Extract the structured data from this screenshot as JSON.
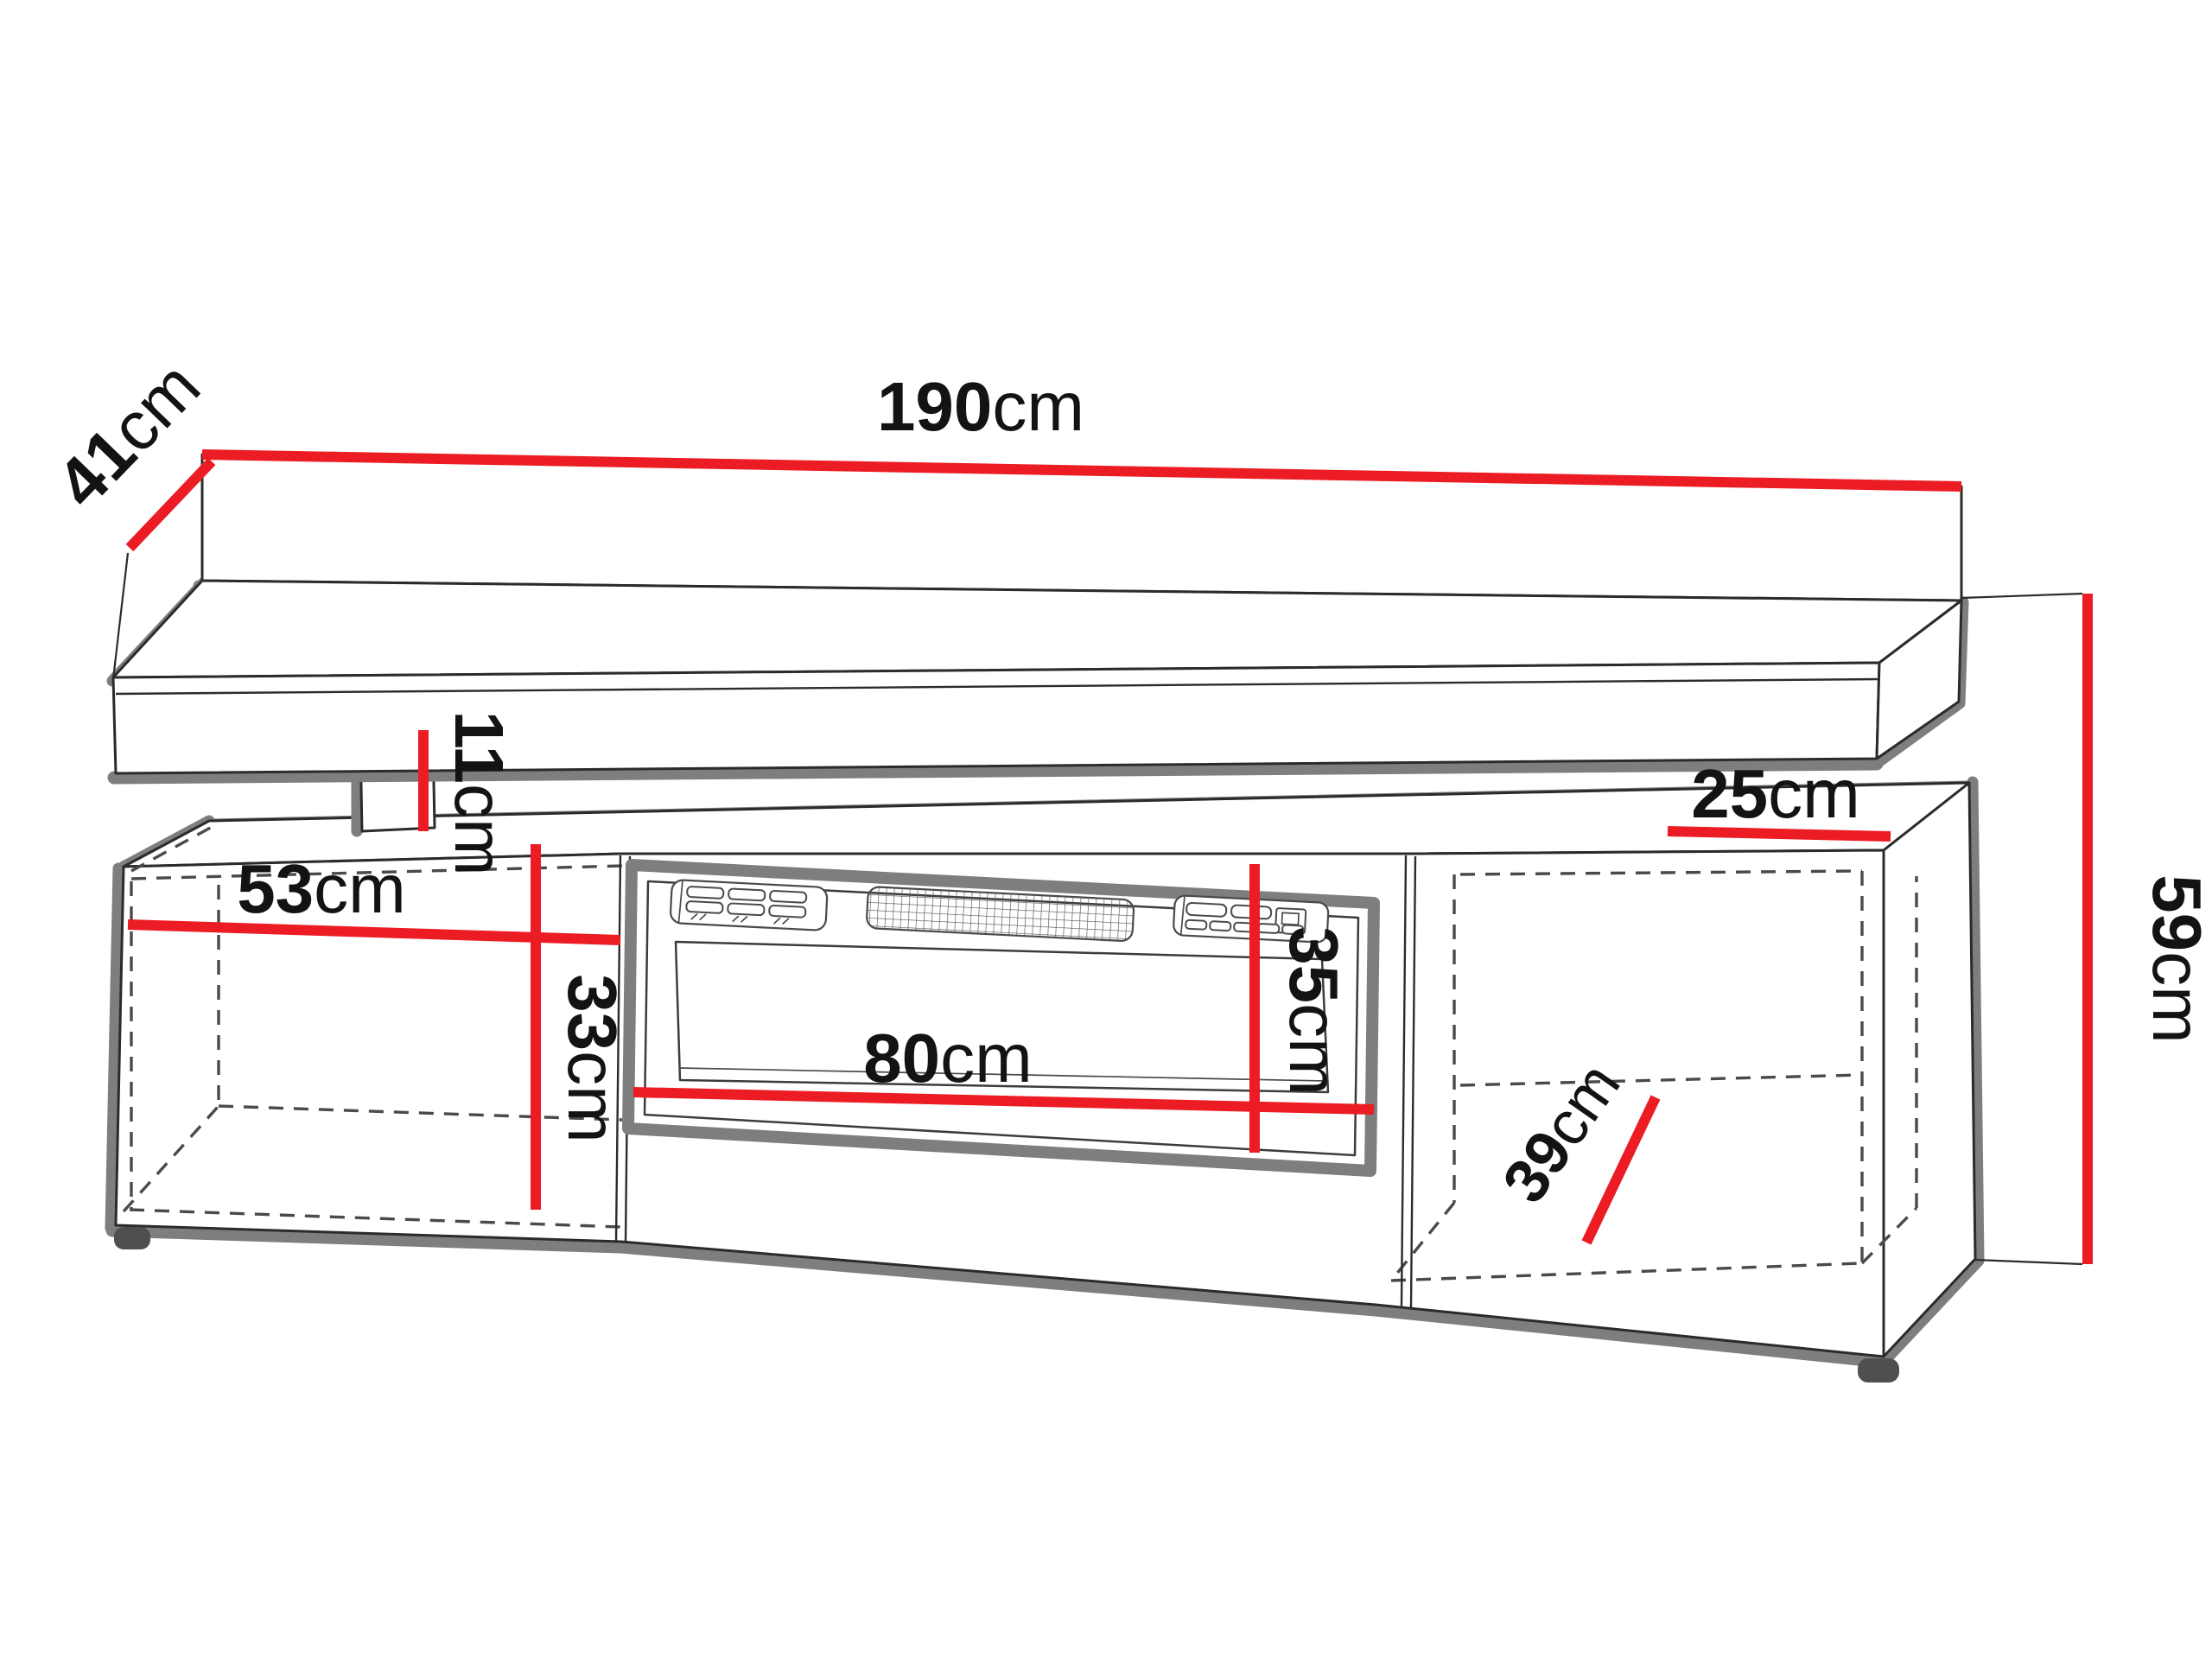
{
  "diagram": {
    "type": "furniture-dimension-diagram",
    "subject": "TV stand with electric fireplace insert and floating wall shelf",
    "unit": "cm",
    "dimensions": {
      "shelf_width": {
        "value": "190",
        "unit": "cm",
        "description": "total width of the floating wall shelf"
      },
      "shelf_depth": {
        "value": "41",
        "unit": "cm",
        "description": "depth of the floating wall shelf"
      },
      "gap_height": {
        "value": "11",
        "unit": "cm",
        "description": "gap between shelf and cabinet top"
      },
      "left_compartment_width": {
        "value": "53",
        "unit": "cm",
        "description": "interior width of left compartment"
      },
      "left_compartment_height": {
        "value": "33",
        "unit": "cm",
        "description": "interior height of left compartment"
      },
      "fireplace_width": {
        "value": "80",
        "unit": "cm",
        "description": "width of fireplace insert"
      },
      "fireplace_height": {
        "value": "35",
        "unit": "cm",
        "description": "height of fireplace insert"
      },
      "right_top_depth": {
        "value": "25",
        "unit": "cm",
        "description": "top depth of right compartment"
      },
      "right_compartment_depth": {
        "value": "39",
        "unit": "cm",
        "description": "interior depth of right compartment"
      },
      "total_height": {
        "value": "59",
        "unit": "cm",
        "description": "total height of the TV cabinet"
      }
    },
    "colors": {
      "dimension_red": "#EC1C24",
      "outline_black": "#2B2B2B",
      "shadow_gray": "#7E7E7E",
      "hidden_line_gray": "#4A4A4A",
      "label_text": "#131313",
      "background": "#FFFFFF"
    }
  }
}
